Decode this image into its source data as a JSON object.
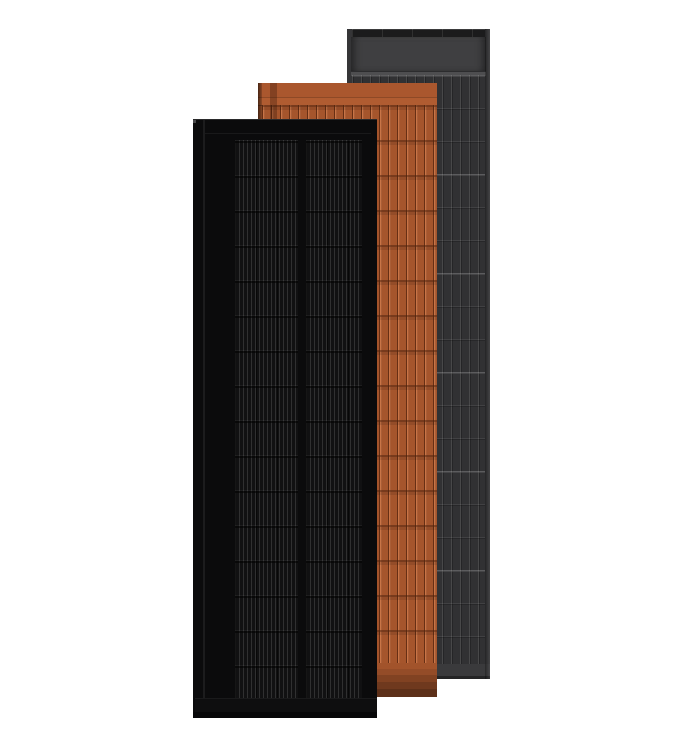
{
  "page": {
    "description": "Product render of three overlapping vertical solar panels on a white background"
  },
  "colors": {
    "bg": "#ffffff",
    "black_frame": "#0b0b0c",
    "black_cell": "#111112",
    "terra_base": "#a5552c",
    "terra_top": "#aa572e",
    "gray_frame": "#353537",
    "gray_base": "#313133",
    "gray_band": "#3f3f41",
    "gray_top_strip": "#1b1b1c",
    "gray_bottom": "#3a3a3c"
  },
  "panels": [
    {
      "id": "black",
      "label": "Matte black solar panel (front)"
    },
    {
      "id": "terracotta",
      "label": "Terracotta solar roof panel (middle)"
    },
    {
      "id": "gray",
      "label": "Anthracite grey solar panel (back)"
    }
  ]
}
